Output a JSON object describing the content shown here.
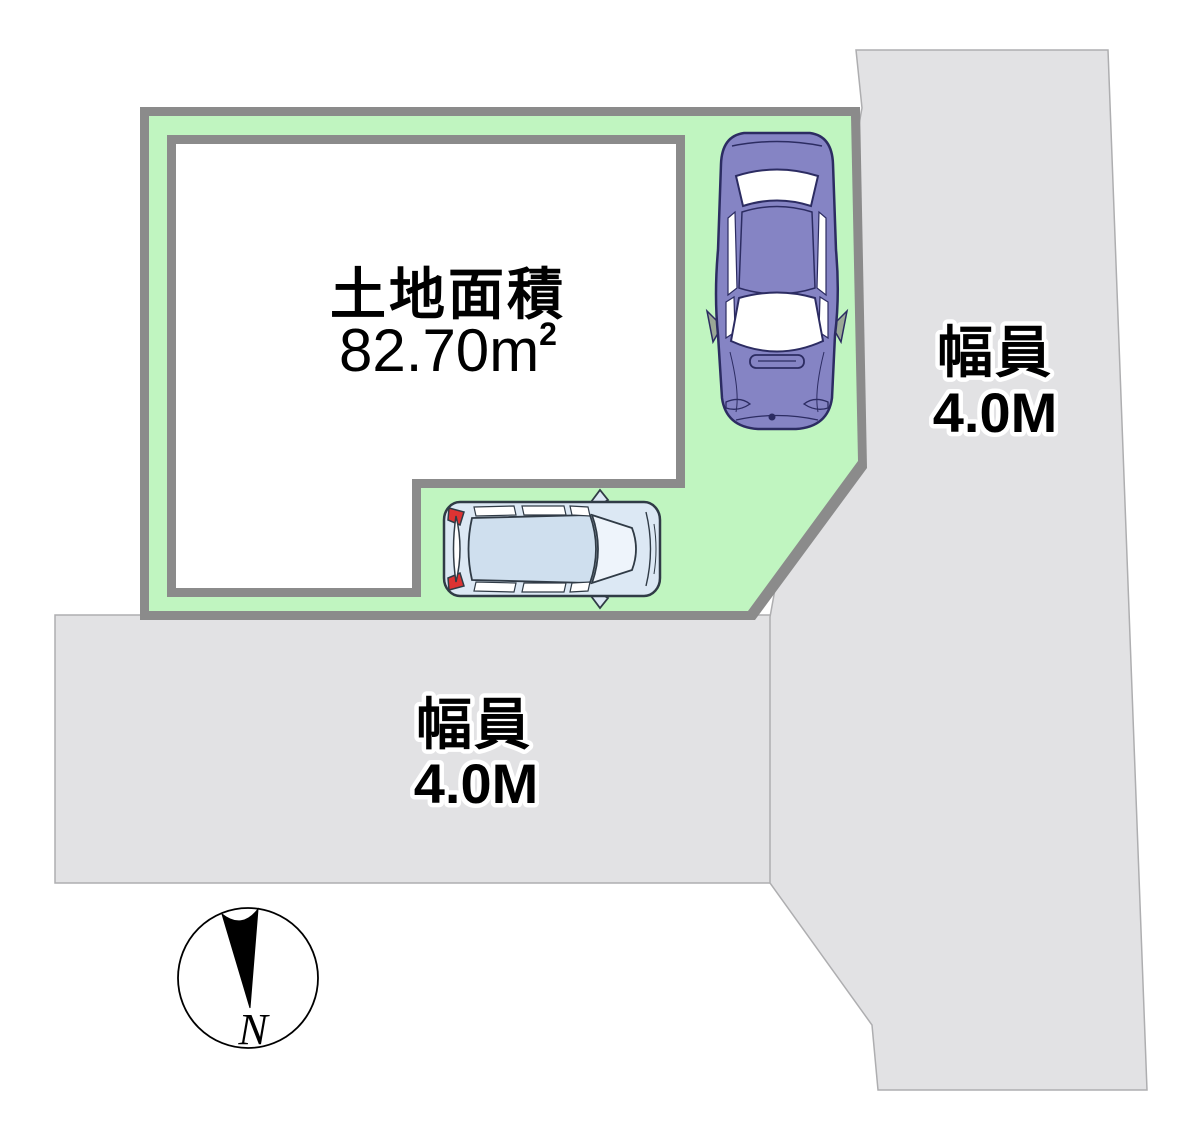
{
  "diagram": {
    "type": "real-estate-plot-layout",
    "land": {
      "area_label": "土地面積",
      "area_value": "82.70",
      "area_unit": "m",
      "area_unit_exponent": "2"
    },
    "roads": {
      "right": {
        "label": "幅員",
        "width": "4.0M"
      },
      "bottom": {
        "label": "幅員",
        "width": "4.0M"
      }
    },
    "compass": {
      "north_label": "N"
    },
    "colors": {
      "plot_green": "#c0f5c0",
      "boundary_gray": "#8b8b8b",
      "building_white": "#ffffff",
      "road_gray": "#e2e2e4",
      "road_stroke": "#aeaeb0",
      "sedan_purple": "#8584c4",
      "sedan_outline": "#2c2c62",
      "wagon_blue": "#dce8f4",
      "wagon_roof_blue": "#cfdfee",
      "wagon_outline": "#303b46",
      "taillight_red": "#dd3333",
      "mirror_gray": "#9aa896",
      "text_black": "#000000"
    }
  }
}
